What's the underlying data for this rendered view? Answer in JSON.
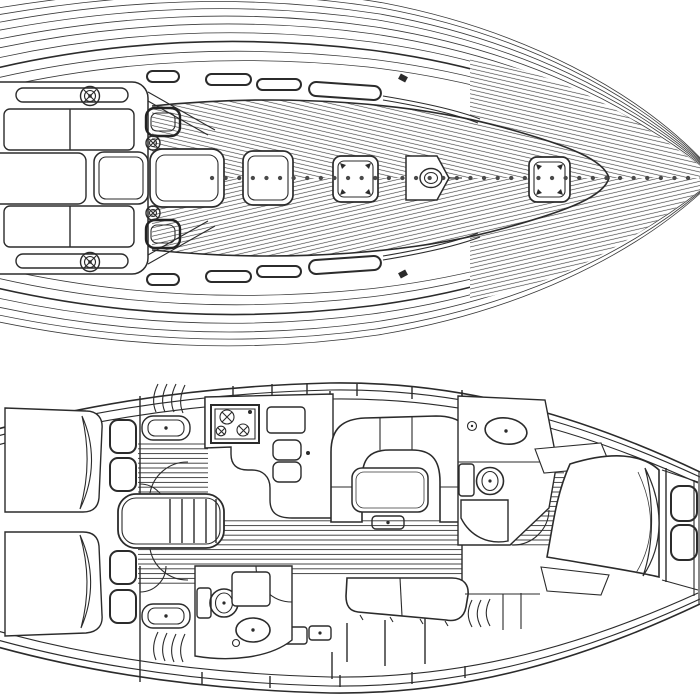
{
  "page": {
    "title": "sailboat-deck-and-interior-plans",
    "background": "#ffffff",
    "ink": "#2b2b2b",
    "drawing_type": "technical line drawing, black on white, two stacked plan views of a sailing yacht"
  },
  "views": {
    "deck": {
      "label": "Deck plan (top view, bow to the right)",
      "components": [
        "stern-cockpit",
        "cockpit-bench-port",
        "cockpit-bench-starboard",
        "cockpit-footwell",
        "bridge-deck-seat",
        "coaming-winch-port",
        "coaming-winch-starboard",
        "cabin-top-winch-port",
        "cabin-top-winch-starboard",
        "cockpit-side-hatch-port",
        "cockpit-side-hatch-starboard",
        "companionway-sliding-hatch",
        "saloon-hatch",
        "midship-hatch",
        "mast-step-and-section",
        "foredeck-hatch",
        "coachroof-window-slots",
        "genoa-track",
        "deck-cleats",
        "teak-deck-planking-curves",
        "diagonal-roof-hatching",
        "dashed-centerline"
      ]
    },
    "interior": {
      "label": "Accommodation plan (interior layout, bow to the right)",
      "components": [
        "aft-double-cabin-starboard",
        "aft-double-cabin-port",
        "aft-berth-fold-back-sheet",
        "aft-cabin-seat-cushions",
        "aft-cabin-vanity-sink",
        "cockpit-locker-vent-fans",
        "companionway-steps-engine-box",
        "swing-doors",
        "galley-counter",
        "galley-stove-with-burners",
        "galley-worktop-board",
        "galley-lockers",
        "saloon-u-settee",
        "saloon-table",
        "saloon-table-pedestal",
        "saloon-straight-bench",
        "sideboard-lockers",
        "aft-head-toilet",
        "aft-head-shower-grating",
        "aft-head-sink",
        "forward-head-vanity-sink",
        "forward-head-toilet",
        "forward-head-shower-grating",
        "wardrobe-x-wedges",
        "forward-cabin-double-berth",
        "forward-berth-fold-back-sheet",
        "bow-shelf-cushions",
        "cabin-sole-plank-stripes",
        "hull-shelf-tick-marks",
        "bulkheads"
      ]
    }
  }
}
